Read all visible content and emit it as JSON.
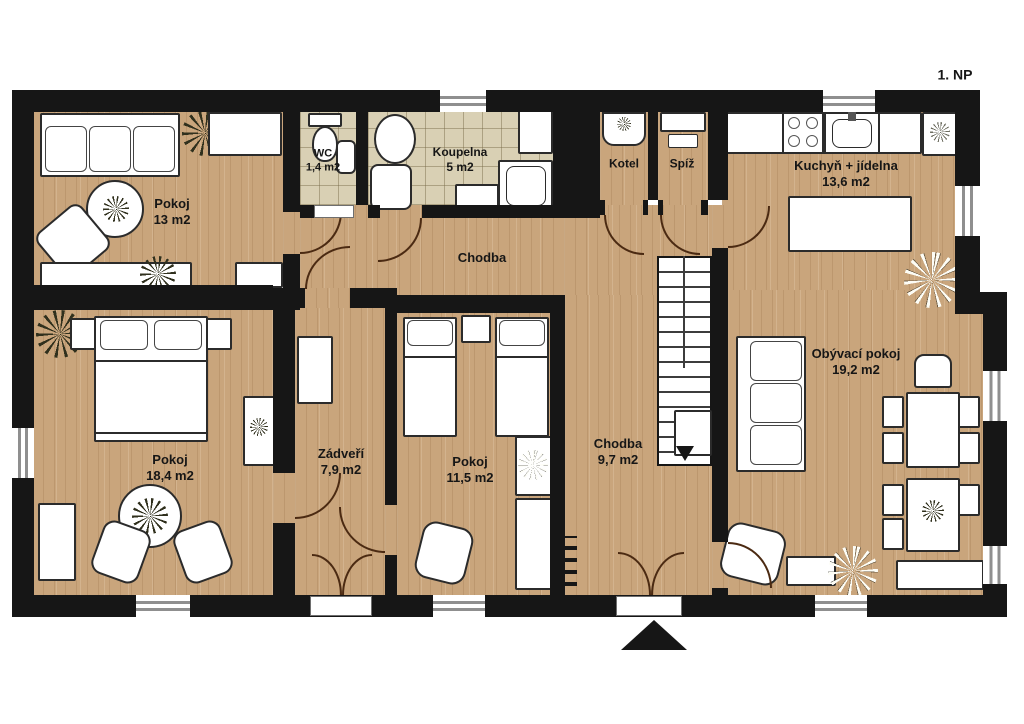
{
  "title": "1. NP",
  "rooms": {
    "pokoj1": {
      "name": "Pokoj",
      "area": "13 m2"
    },
    "wc": {
      "name": "WC",
      "area": "1,4 m2"
    },
    "koupelna": {
      "name": "Koupelna",
      "area": "5 m2"
    },
    "kotel": {
      "name": "Kotel"
    },
    "spiz": {
      "name": "Spíž"
    },
    "kuchyn": {
      "name": "Kuchyň + jídelna",
      "area": "13,6 m2"
    },
    "chodba1": {
      "name": "Chodba"
    },
    "pokoj2": {
      "name": "Pokoj",
      "area": "18,4 m2"
    },
    "zadveri": {
      "name": "Zádveří",
      "area": "7,9 m2"
    },
    "pokoj3": {
      "name": "Pokoj",
      "area": "11,5 m2"
    },
    "chodba2": {
      "name": "Chodba",
      "area": "9,7 m2"
    },
    "obyvaci": {
      "name": "Obývací pokoj",
      "area": "19,2 m2"
    }
  },
  "colors": {
    "wall": "#161616",
    "wood": "#c9a57c",
    "tile": "#d9d0b4",
    "door_arc": "#4b2a12"
  }
}
